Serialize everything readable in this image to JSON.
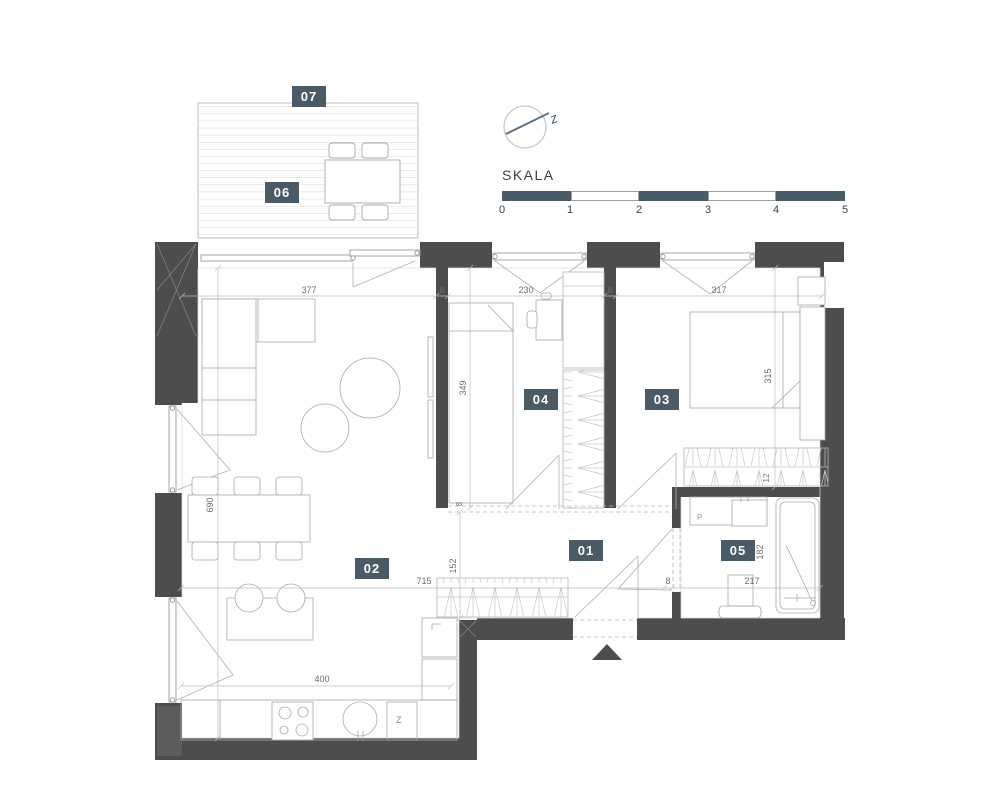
{
  "rooms": [
    {
      "label": "01"
    },
    {
      "label": "02"
    },
    {
      "label": "03"
    },
    {
      "label": "04"
    },
    {
      "label": "05"
    },
    {
      "label": "06"
    },
    {
      "label": "07"
    }
  ],
  "compass": {
    "label": "z"
  },
  "scale": {
    "title": "SKALA",
    "ticks": [
      "0",
      "1",
      "2",
      "3",
      "4",
      "5"
    ]
  },
  "dims": [
    {
      "text": "377"
    },
    {
      "text": "8"
    },
    {
      "text": "230"
    },
    {
      "text": "8"
    },
    {
      "text": "317"
    },
    {
      "text": "349"
    },
    {
      "text": "315"
    },
    {
      "text": "690"
    },
    {
      "text": "12"
    },
    {
      "text": "152"
    },
    {
      "text": "182"
    },
    {
      "text": "8"
    },
    {
      "text": "715"
    },
    {
      "text": "8"
    },
    {
      "text": "217"
    },
    {
      "text": "400"
    }
  ],
  "appliances": {
    "washer": "P",
    "dishwasher": "Z"
  },
  "colors": {
    "wall": "#4d4d4d",
    "accent": "#4a5b68",
    "line": "#b5b5b5"
  }
}
